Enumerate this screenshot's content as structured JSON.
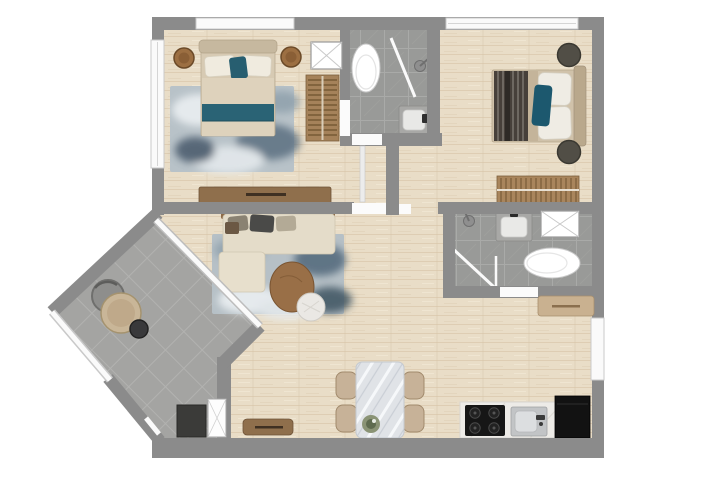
{
  "meta": {
    "type": "2d-apartment-floor-plan",
    "canvas": {
      "width": 702,
      "height": 493
    },
    "visible_text": [],
    "style": "top-down rendered plan, gray walls, light oak flooring, gray tile wet areas"
  },
  "palette": {
    "wall_gray": "#8b8b8b",
    "wood_floor": "#e9ddc7",
    "bath_tile": "#9a9a98",
    "balcony_tile": "#a4a4a2",
    "accent_teal": "#256276",
    "furniture_wood": "#8f6f4c",
    "upholstery_beige": "#e4dcc9",
    "rug_blue_gray": "#b6c0c6",
    "appliance_black": "#161616",
    "window_white": "#fafafa"
  },
  "counts": {
    "bedrooms": 2,
    "bathrooms": 2,
    "balconies": 1,
    "dining_chairs": 4,
    "cooktop_burners": 4,
    "round_nightstands": 4
  },
  "rooms": [
    {
      "id": "bedroom-1",
      "name": "Bedroom 1",
      "position": "top-left",
      "furniture": [
        "double bed with teal runner",
        "two round wood nightstands",
        "mottled blue area rug",
        "low dresser",
        "slatted ladder shelf",
        "white utility box"
      ]
    },
    {
      "id": "bathroom-1",
      "name": "Bathroom 1",
      "position": "top-center",
      "fixtures": [
        "toilet",
        "corner walk-in shower",
        "washbasin"
      ]
    },
    {
      "id": "bedroom-2",
      "name": "Bedroom 2",
      "position": "top-right",
      "furniture": [
        "double bed with dark striped blanket and teal pillow",
        "two dark round nightstands",
        "slatted bench",
        "long top window"
      ]
    },
    {
      "id": "bathroom-2",
      "name": "Bathroom 2",
      "position": "middle-right",
      "fixtures": [
        "walk-in shower with glass panel",
        "washbasin",
        "white utility box",
        "toilet"
      ],
      "furniture": [
        "beige console below"
      ]
    },
    {
      "id": "living-room",
      "name": "Living Room",
      "position": "center",
      "furniture": [
        "L-shaped beige sofa with cushions",
        "mottled blue area rug",
        "round wood coffee table",
        "round white side table"
      ]
    },
    {
      "id": "dining-area",
      "name": "Dining Area",
      "position": "bottom-center",
      "furniture": [
        "marble dining table",
        "four beige chairs",
        "plant centerpiece",
        "wood sideboard bench"
      ]
    },
    {
      "id": "kitchen",
      "name": "Kitchen",
      "position": "bottom-right",
      "fixtures": [
        "white stone counter",
        "4-burner black cooktop",
        "inset sink with faucet",
        "black refrigerator"
      ]
    },
    {
      "id": "balcony",
      "name": "Balcony",
      "position": "bottom-left-diagonal",
      "furniture": [
        "gray lounge chair",
        "round beige table",
        "small dark side table"
      ],
      "features": [
        "white glass railing",
        "full-width glass door to living room"
      ]
    },
    {
      "id": "entry",
      "name": "Entry",
      "position": "bottom-left",
      "furniture": [
        "dark shoe cabinet",
        "tall white closet"
      ]
    }
  ]
}
